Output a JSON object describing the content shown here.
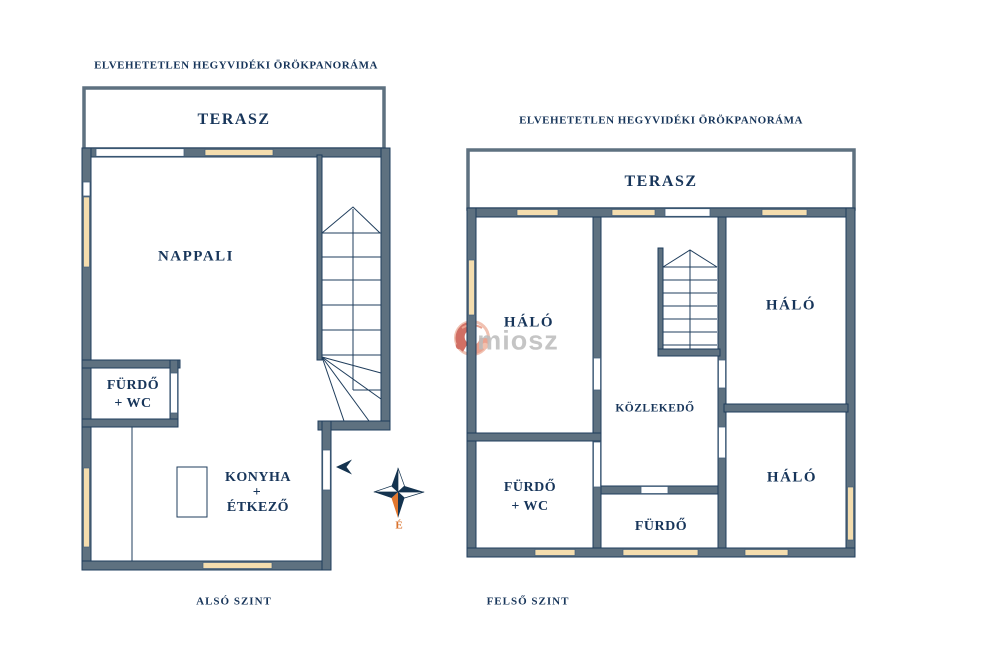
{
  "colors": {
    "wall_fill": "#5e7180",
    "wall_outline": "#1f3d5c",
    "window_fill": "#f4ddae",
    "label_navy": "#17355a",
    "compass_navy": "#14334f",
    "compass_orange": "#e2772e",
    "watermark_gray": "#bcbcbc",
    "watermark_salmon": "#e8927c"
  },
  "floor_plans": [
    {
      "id": "also-szint",
      "header": "ELVEHETETLEN HEGYVIDÉKI ÖRÖKPANORÁMA",
      "floor_label": "ALSÓ SZINT",
      "rooms": {
        "terasz": "TERASZ",
        "nappali": "NAPPALI",
        "furdo_line1": "FÜRDŐ",
        "furdo_line2": "+ WC",
        "konyha_line1": "KONYHA",
        "konyha_line2": "+",
        "konyha_line3": "ÉTKEZŐ"
      }
    },
    {
      "id": "felso-szint",
      "header": "ELVEHETETLEN HEGYVIDÉKI ÖRÖKPANORÁMA",
      "floor_label": "FELSŐ SZINT",
      "rooms": {
        "terasz": "TERASZ",
        "halo_left": "HÁLÓ",
        "halo_top_right": "HÁLÓ",
        "halo_bottom_right": "HÁLÓ",
        "kozlekedo": "KÖZLEKEDŐ",
        "furdo_wc_line1": "FÜRDŐ",
        "furdo_wc_line2": "+ WC",
        "furdo": "FÜRDŐ"
      }
    }
  ],
  "compass": {
    "north_label": "É"
  },
  "watermark": {
    "text": "miosz",
    "logo": "miosz-logo"
  }
}
